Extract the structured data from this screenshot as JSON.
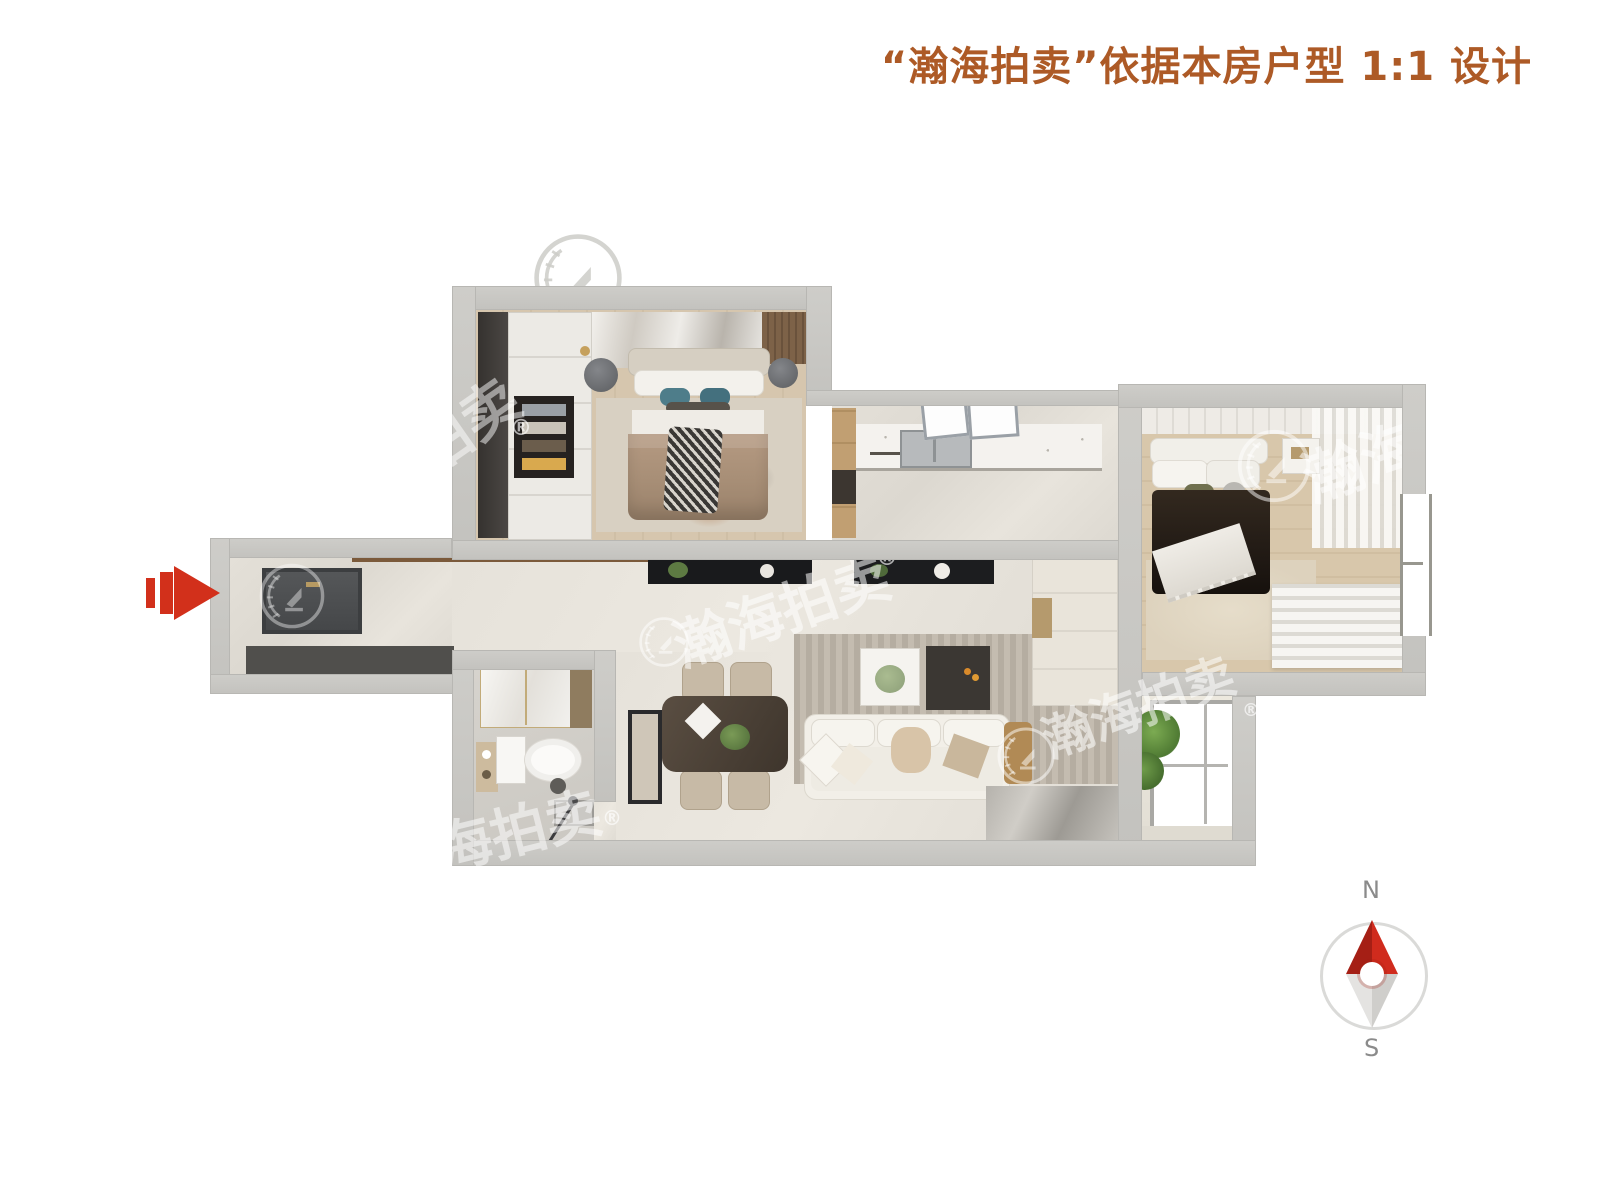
{
  "header": {
    "title": "“瀚海拍卖”依据本房户型 1:1 设计",
    "color": "#ad5a26"
  },
  "compass": {
    "north_label": "N",
    "south_label": "S",
    "icon": "compass-needle",
    "needle_north_color": "#c9281b",
    "needle_south_color": "#d8d7d4"
  },
  "entry": {
    "arrow_icon": "entry-direction-arrow-right",
    "arrow_color": "#d2301b"
  },
  "watermark": {
    "brand": "瀚海拍卖",
    "brand_partial_bedroom": "拍卖",
    "brand_partial_right": "瀚海拍",
    "brand_partial_bath": "海拍卖",
    "registered": "®",
    "logo_icon": "laurel-wreath-badge"
  },
  "palette": {
    "background": "#ffffff",
    "wall": "#c9c8c4",
    "floor_wood": "#d6c6ae",
    "floor_marble": "#e2ded6",
    "accent_red": "#d2301b"
  }
}
